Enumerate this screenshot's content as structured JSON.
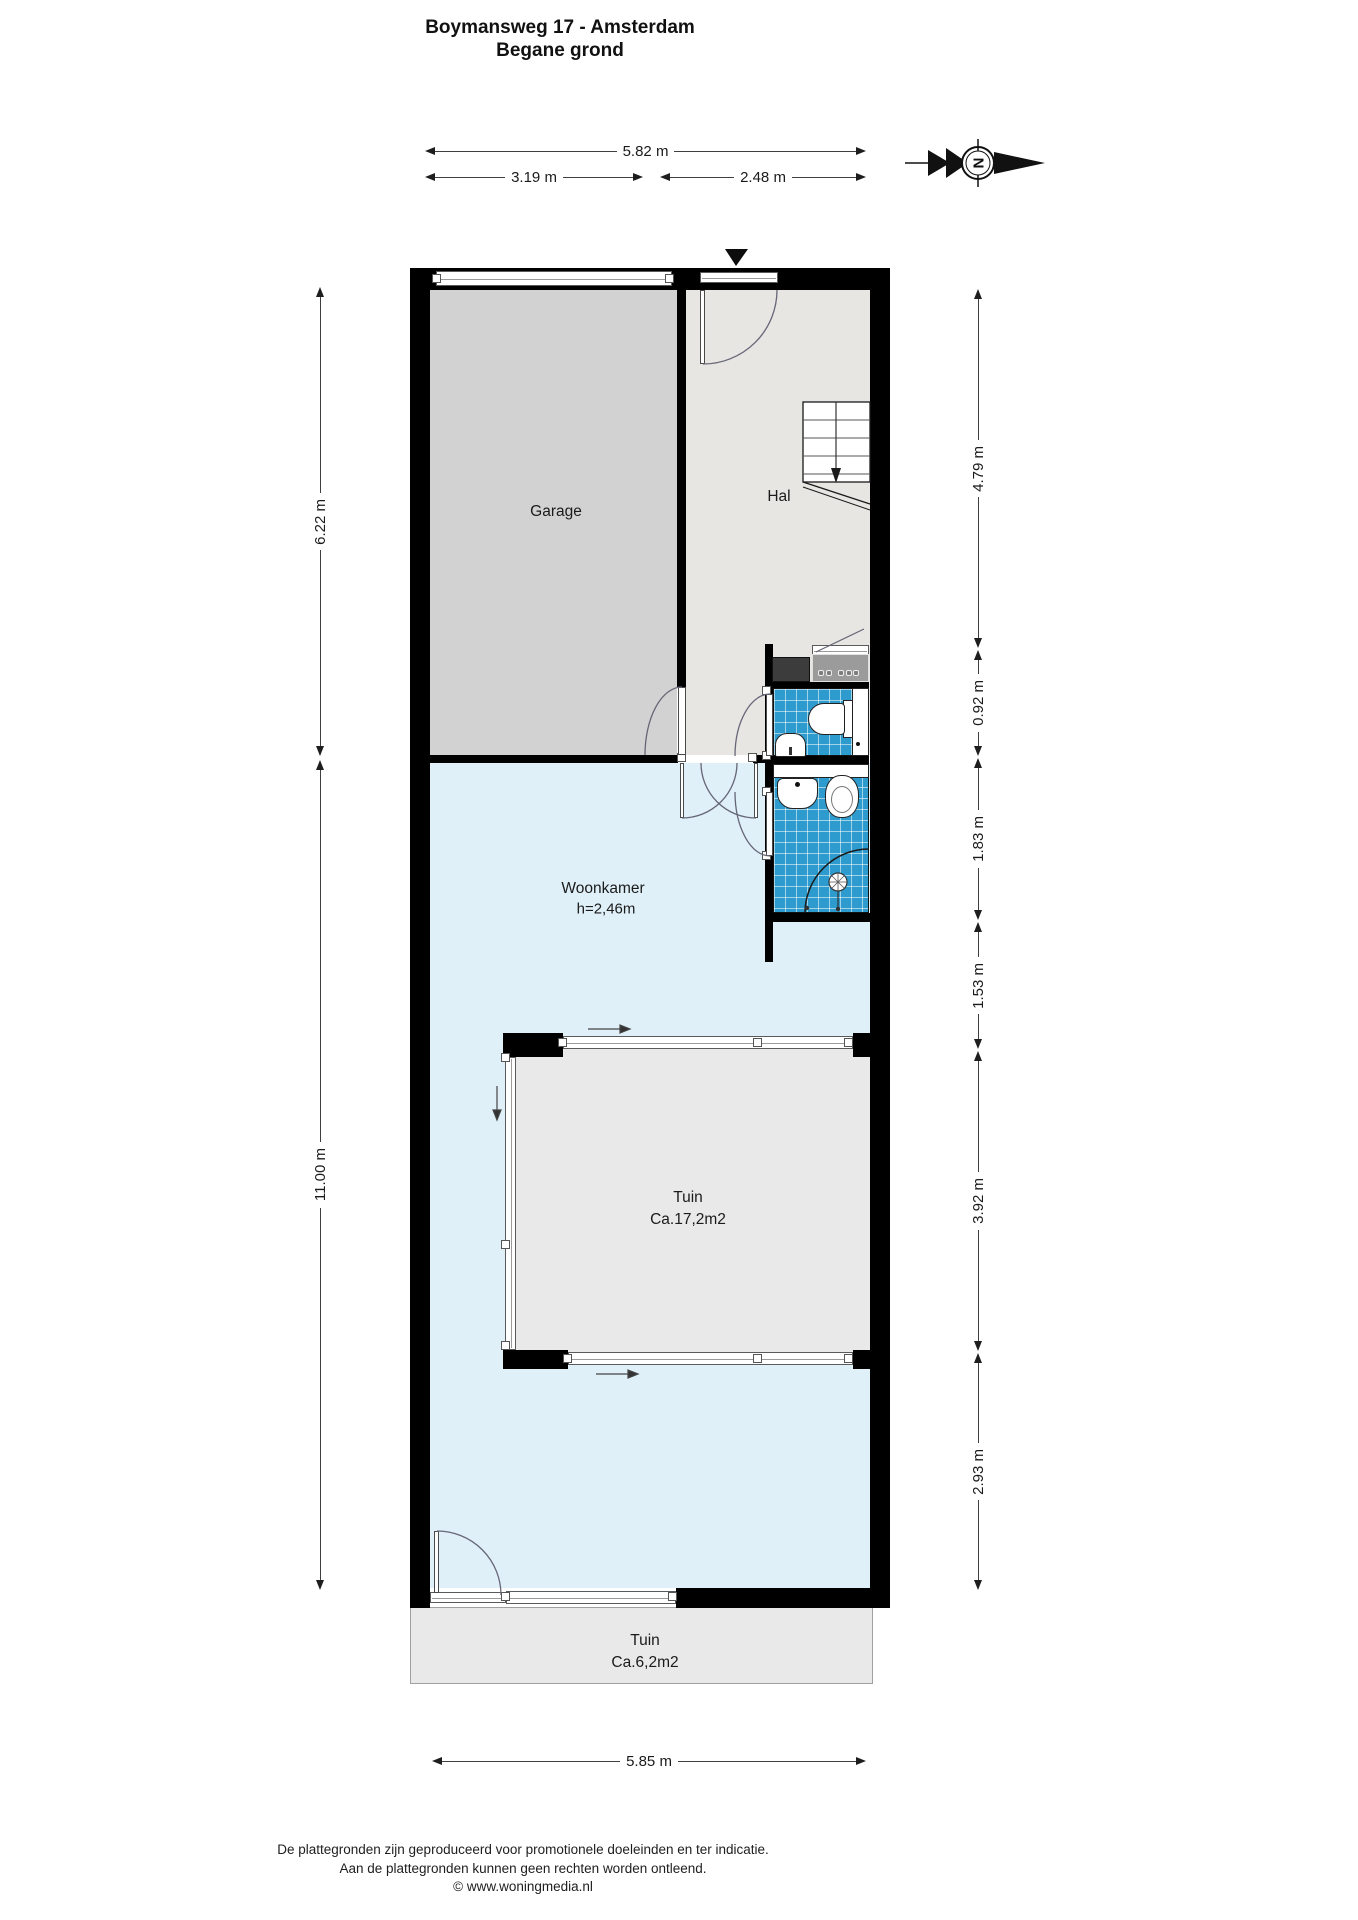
{
  "title": {
    "line1": "Boymansweg 17 - Amsterdam",
    "line2": "Begane grond"
  },
  "compass": {
    "north_letter": "N"
  },
  "rooms": {
    "garage": {
      "label": "Garage"
    },
    "hal": {
      "label": "Hal"
    },
    "woonkamer": {
      "label": "Woonkamer",
      "ceiling_height": "h=2,46m"
    },
    "patio": {
      "label": "Tuin",
      "area": "Ca.17,2m2"
    },
    "garden": {
      "label": "Tuin",
      "area": "Ca.6,2m2"
    }
  },
  "dimensions": {
    "top_total": "5.82 m",
    "top_left": "3.19 m",
    "top_right": "2.48 m",
    "left_top": "6.22 m",
    "left_bottom": "11.00 m",
    "right_1": "4.79 m",
    "right_2": "0.92 m",
    "right_3": "1.83 m",
    "right_4": "1.53 m",
    "right_5": "3.92 m",
    "right_6": "2.93 m",
    "bottom_total": "5.85 m"
  },
  "footer": {
    "line1": "De plattegronden zijn geproduceerd voor promotionele doeleinden en ter indicatie.",
    "line2": "Aan de plattegronden kunnen geen rechten worden ontleend.",
    "line3": "© www.woningmedia.nl"
  },
  "colors": {
    "wall": "#000000",
    "garage_floor": "#d2d2d2",
    "hal_floor": "#e7e6e2",
    "woonkamer_floor": "#dff0f8",
    "tile_blue": "#2d9bcd",
    "tuin_grey": "#e9e9e9",
    "counter_grey": "#9b9b9b",
    "appliance_dark": "#3c3c3c"
  }
}
